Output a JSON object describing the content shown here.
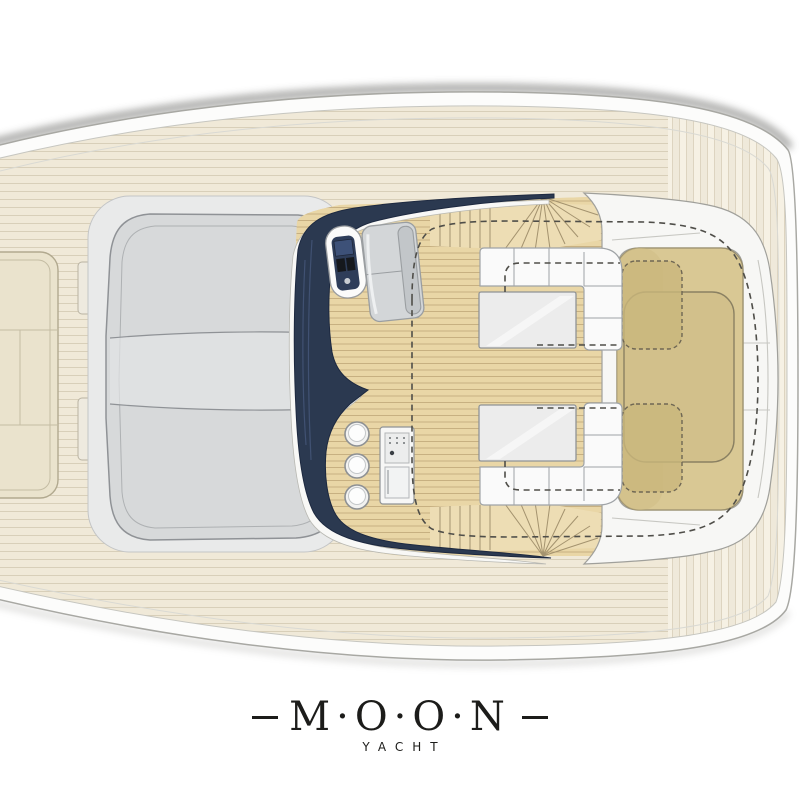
{
  "logo": {
    "name": "M·O·O·N",
    "subtitle": "YACHT"
  },
  "illustration": {
    "kind": "yacht-deck-plan-top-view"
  },
  "palette": {
    "background": "#ffffff",
    "hull_white": "#fcfcfb",
    "hull_outline": "#a8a8a3",
    "deck_plank": "#f0e9d8",
    "deck_seam": "#d8cfb9",
    "teak": "#e9d6a6",
    "teak_seam": "#c7b081",
    "aft_plank": "#efe9da",
    "windshield_navy": "#2b3950",
    "cushion_white": "#fafafa",
    "cushion_outline": "#9fa3a6",
    "sunpad_khaki": "#d9c894",
    "sunpad_dark": "#c9b67c",
    "sunpad_outline": "#9a8f6d",
    "foredeck_gray": "#d7d9da",
    "foredeck_outline": "#8f9296",
    "bow_pad": "#eae3cd",
    "coaming_white": "#f7f7f5",
    "table_top": "#ececec",
    "dash_line": "#4f4e49",
    "logo_ink": "#1c1c1a"
  }
}
